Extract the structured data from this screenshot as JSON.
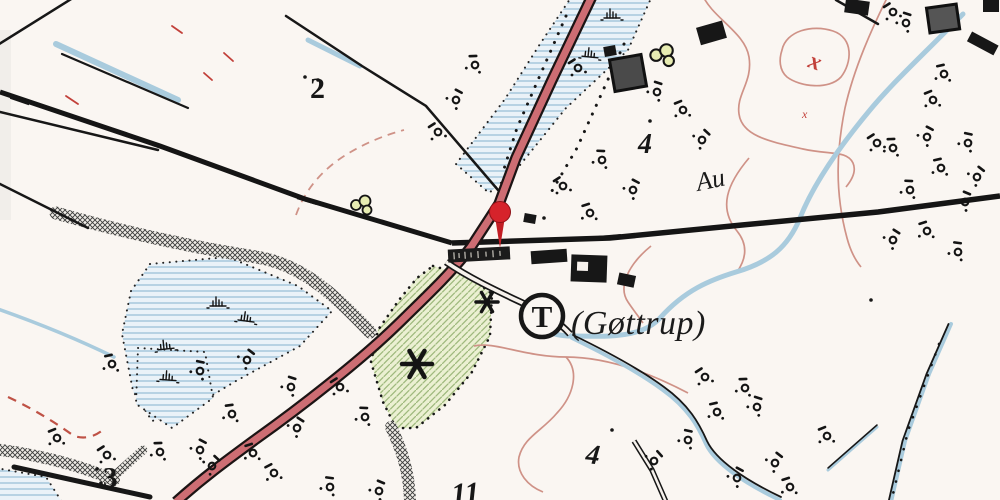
{
  "map": {
    "place_label": "(Gøttrup)",
    "halt_symbol": "T",
    "stream_label": "Au",
    "parcel_numbers": {
      "top_left": "2",
      "upper_right": "4",
      "lower_right": "4",
      "bottom_left": "3",
      "bottom_center": "11"
    },
    "marks": {
      "x_large": "x",
      "x_small": "x"
    },
    "colors": {
      "background": "#faf6f2",
      "ink": "#171717",
      "road_fill": "#cd6d73",
      "water": "#a9cbdd",
      "marsh_fill": "#eaf2f8",
      "orchard_fill": "#ebf0d2",
      "contour": "#cf9287",
      "red_mark": "#c2403a",
      "pin": "#d6232b"
    }
  }
}
